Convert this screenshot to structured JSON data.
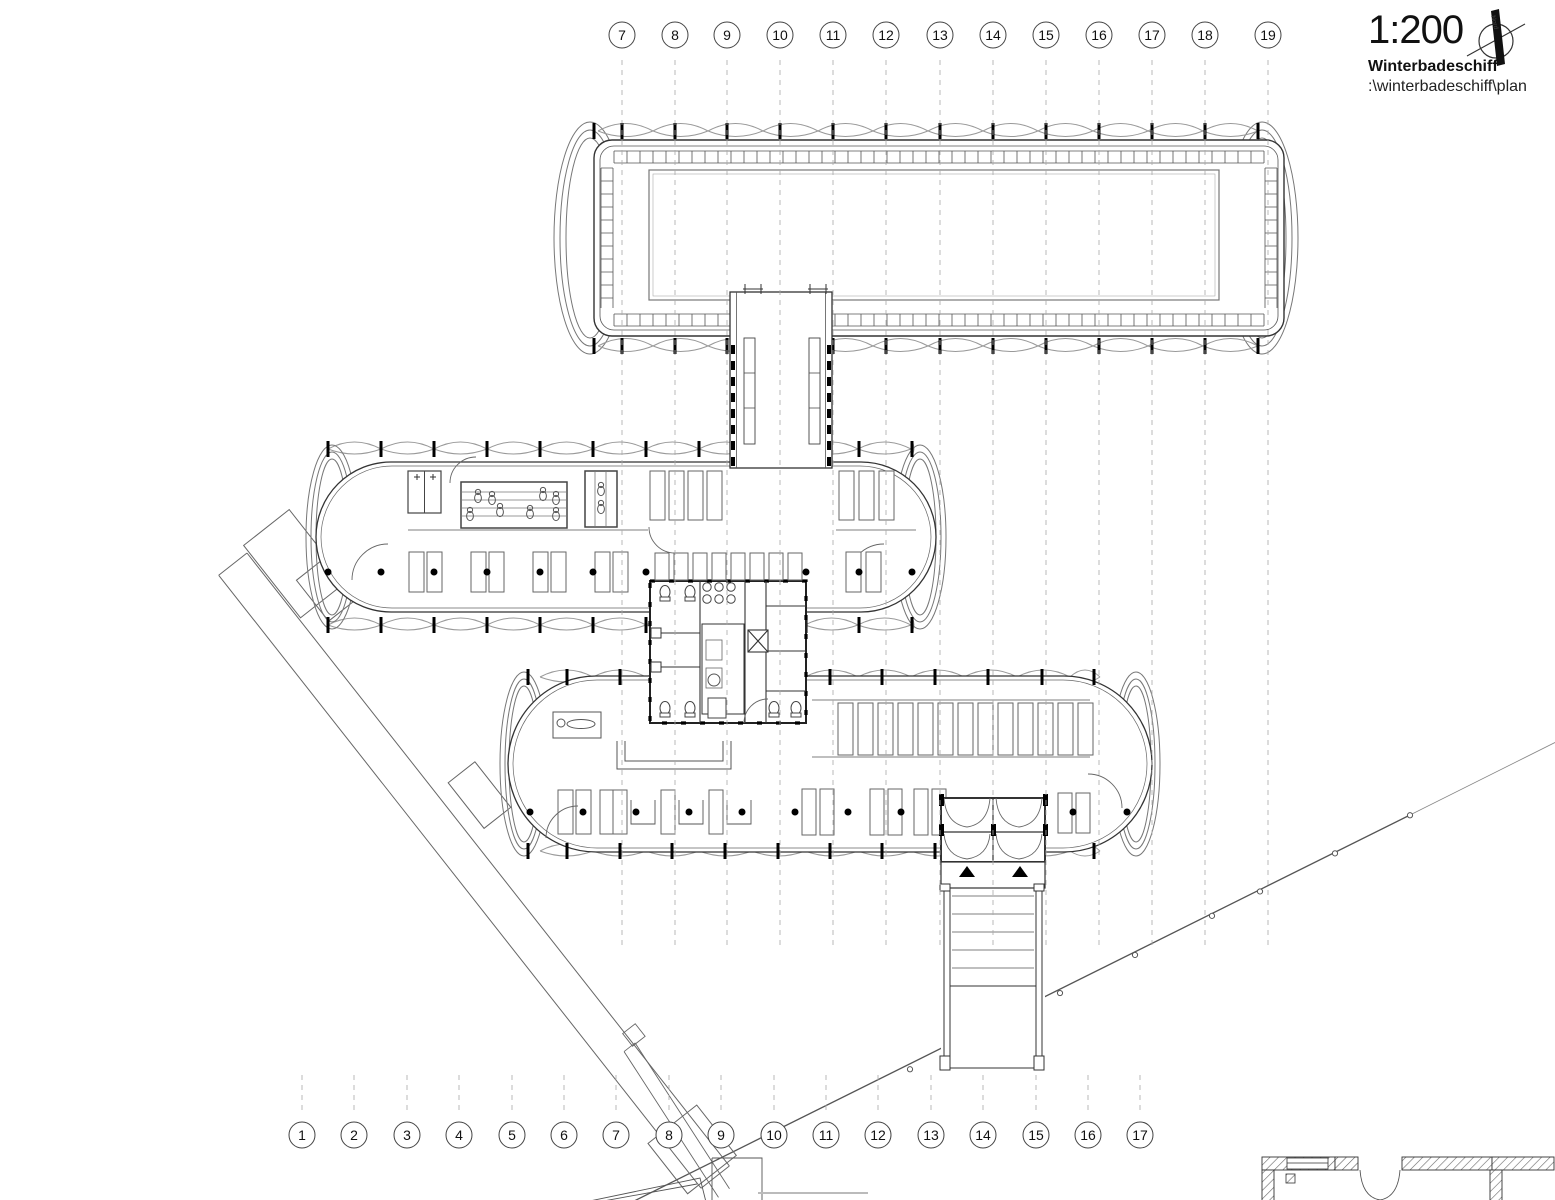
{
  "title_block": {
    "scale": "1:200",
    "project": "Winterbadeschiff",
    "file_path": ":\\winterbadeschiff\\plan",
    "north_label": "Nord"
  },
  "grid": {
    "top": [
      "7",
      "8",
      "9",
      "10",
      "11",
      "12",
      "13",
      "14",
      "15",
      "16",
      "17",
      "18",
      "19"
    ],
    "bottom": [
      "1",
      "2",
      "3",
      "4",
      "5",
      "6",
      "7",
      "8",
      "9",
      "10",
      "11",
      "12",
      "13",
      "14",
      "15",
      "16",
      "17"
    ]
  },
  "colors": {
    "ink": "#333333",
    "light_line": "#999999",
    "grid_line": "#a8a8a8",
    "black": "#000000",
    "paper": "#ffffff"
  }
}
